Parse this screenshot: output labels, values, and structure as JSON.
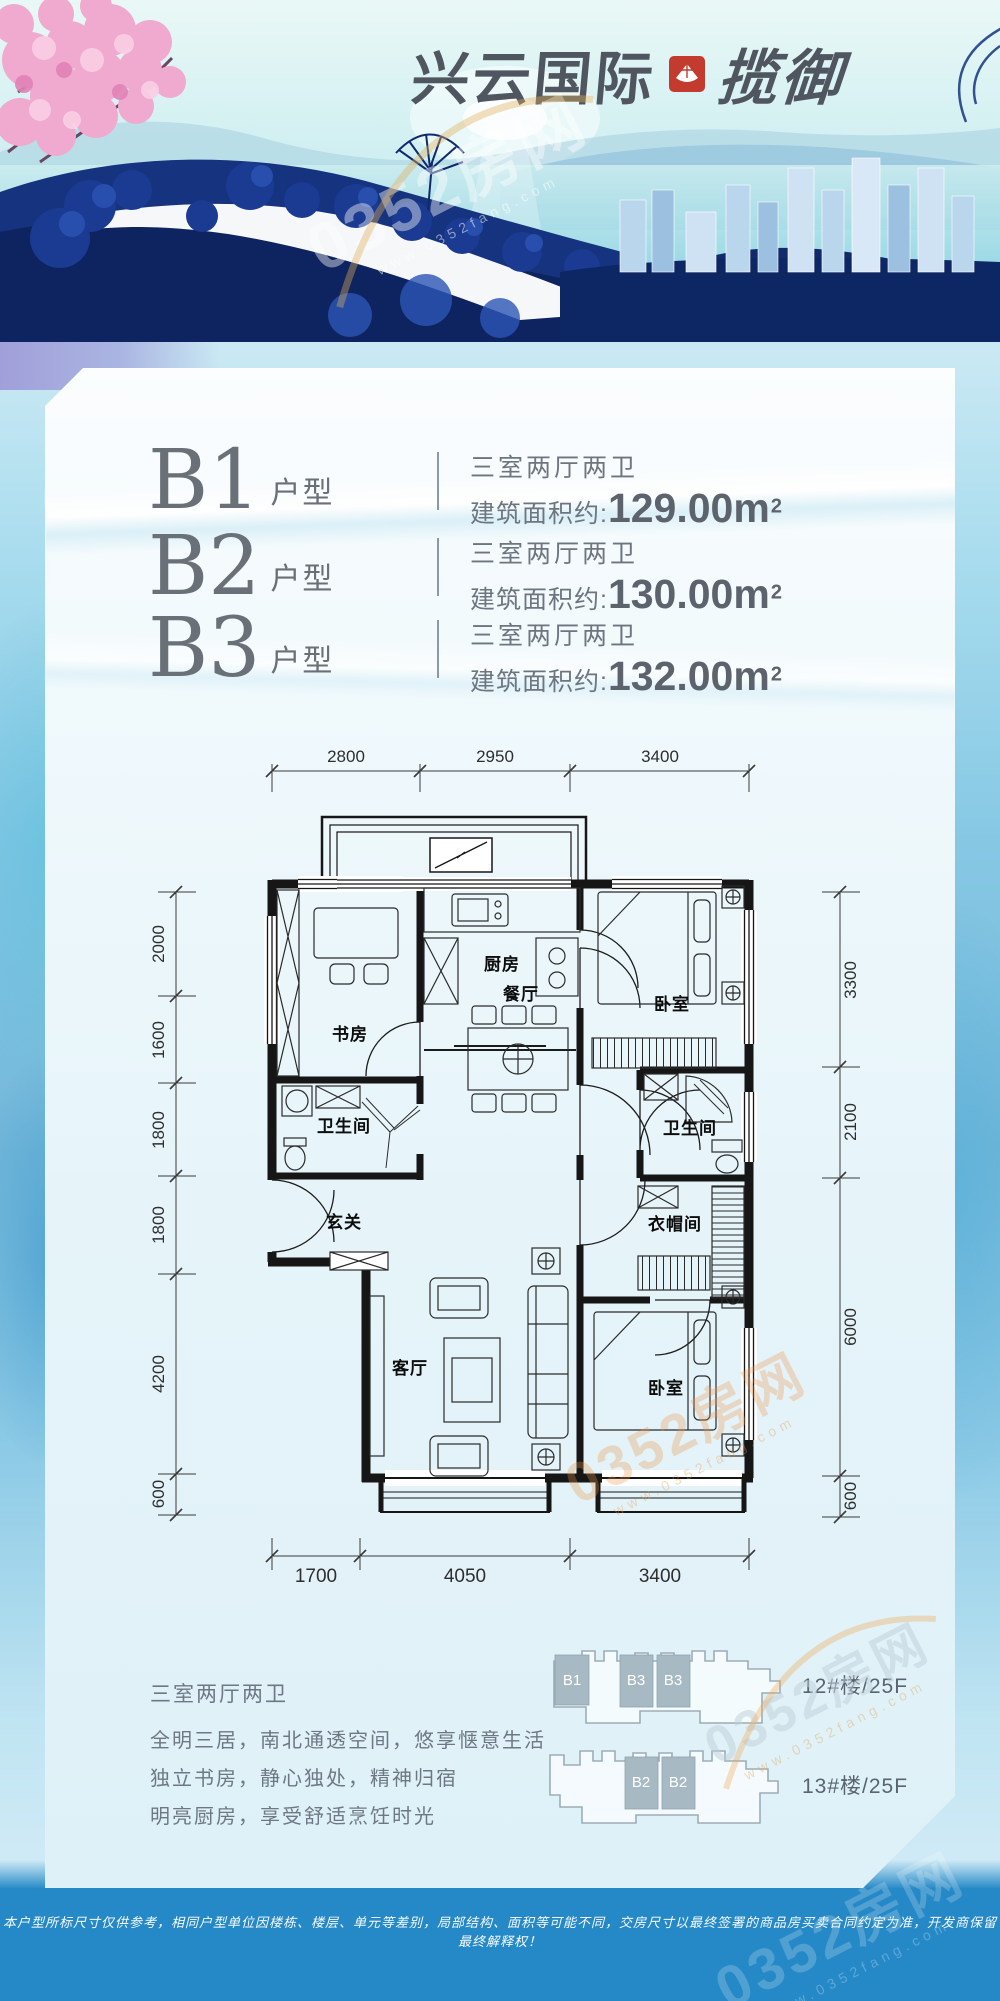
{
  "header": {
    "brand": "兴云国际",
    "sub_brand": "揽御"
  },
  "watermark": {
    "text": "0352房网",
    "site": "www.0352fang.com"
  },
  "units": [
    {
      "code": "B1",
      "type_suffix": "户型",
      "layout": "三室两厅两卫",
      "area_label": "建筑面积约:",
      "area_value": "129.00",
      "area_unit": "m",
      "area_sup": "2"
    },
    {
      "code": "B2",
      "type_suffix": "户型",
      "layout": "三室两厅两卫",
      "area_label": "建筑面积约:",
      "area_value": "130.00",
      "area_unit": "m",
      "area_sup": "2"
    },
    {
      "code": "B3",
      "type_suffix": "户型",
      "layout": "三室两厅两卫",
      "area_label": "建筑面积约:",
      "area_value": "132.00",
      "area_unit": "m",
      "area_sup": "2"
    }
  ],
  "floorplan": {
    "dims_top": [
      "2800",
      "2950",
      "3400"
    ],
    "dims_bottom": [
      "1700",
      "4050",
      "3400"
    ],
    "dims_left": [
      "2000",
      "1600",
      "1800",
      "1800",
      "4200",
      "600"
    ],
    "dims_right": [
      "3300",
      "2100",
      "6000",
      "600"
    ],
    "rooms": {
      "study": "书房",
      "kitchen": "厨房",
      "dining": "餐厅",
      "bedroom_top": "卧室",
      "bath_left": "卫生间",
      "bath_right": "卫生间",
      "entry": "玄关",
      "living": "客厅",
      "cloakroom": "衣帽间",
      "bedroom_bottom": "卧室"
    }
  },
  "description": {
    "title": "三室两厅两卫",
    "lines": [
      "全明三居，南北通透空间，悠享惬意生活",
      "独立书房，静心独处，精神归宿",
      "明亮厨房，享受舒适烹饪时光"
    ]
  },
  "buildings": [
    {
      "label": "12#楼/25F",
      "units": [
        "B1",
        "B3",
        "B3"
      ]
    },
    {
      "label": "13#楼/25F",
      "units": [
        "B2",
        "B2"
      ]
    }
  ],
  "footer": {
    "disclaimer": "本户型所标尺寸仅供参考，相同户型单位因楼栋、楼层、单元等差别，局部结构、面积等可能不同，交房尺寸以最终签署的商品房买卖合同约定为准，开发商保留最终解释权！"
  },
  "colors": {
    "footer_blue": "#2689c7",
    "seal_red": "#c23b2e",
    "text_gray": "#6d7580",
    "plan_line": "#161616",
    "unit_highlight": "#a7bac4"
  }
}
